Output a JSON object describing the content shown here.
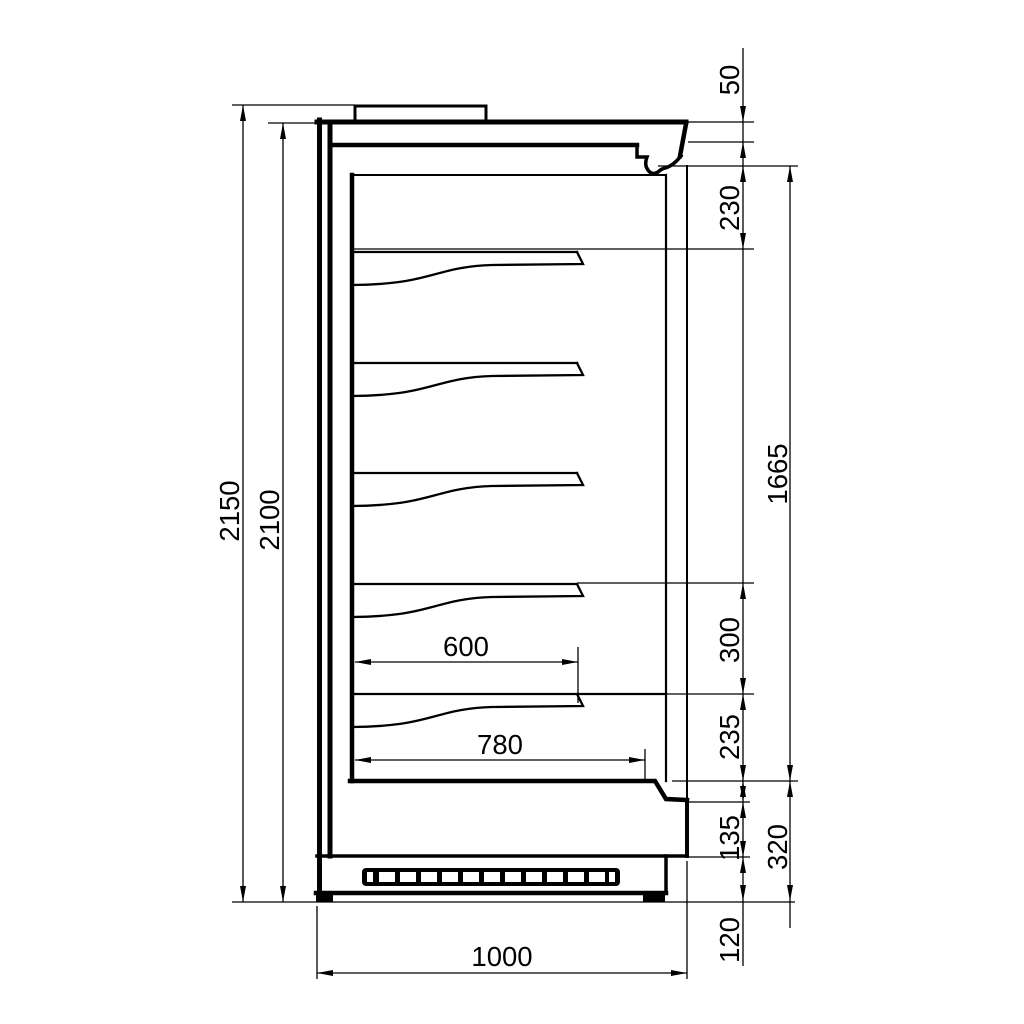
{
  "drawing": {
    "type": "technical-section-side-view",
    "subject": "multideck-display-cabinet",
    "units": "mm",
    "line_color": "#000000",
    "background_color": "#ffffff"
  },
  "dims": {
    "overall_height": "2150",
    "body_height": "2100",
    "canopy_front": "50",
    "canopy_to_first_shelf": "230",
    "interior_height": "1665",
    "shelf_spacing": "300",
    "last_shelf_to_deck": "235",
    "front_lower_panel": "135",
    "base_section": "320",
    "plinth_height": "120",
    "shelf_depth": "600",
    "deck_depth": "780",
    "overall_depth": "1000"
  }
}
